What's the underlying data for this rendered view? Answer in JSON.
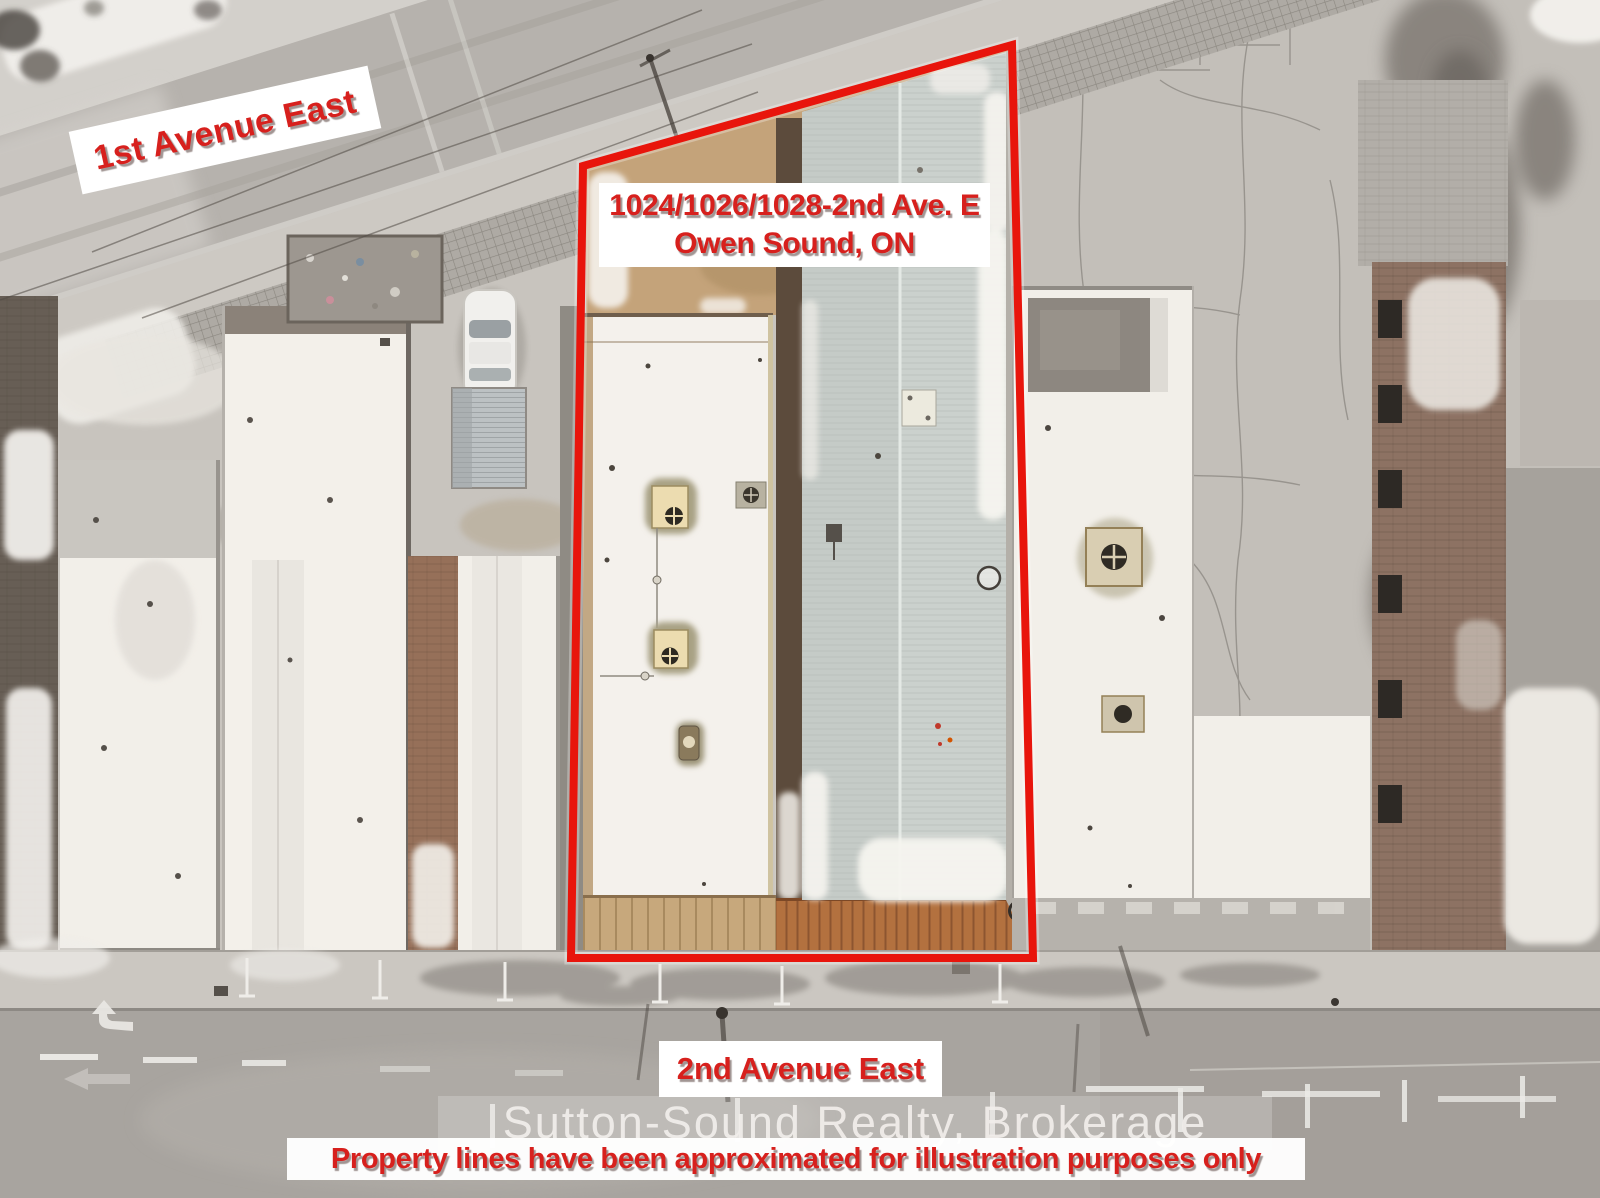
{
  "labels": {
    "street_top": "1st Avenue East",
    "address_line1": "1024/1026/1028-2nd Ave. E",
    "address_line2": "Owen Sound, ON",
    "street_bottom": "2nd Avenue East",
    "watermark": "Sutton-Sound Realty, Brokerage",
    "disclaimer": "Property lines have been approximated for illustration purposes only"
  },
  "colors": {
    "boundary_red": "#e8150c",
    "label_text_red": "#d7201d",
    "label_background": "#ffffff",
    "watermark_text": "#f1eee9",
    "snow": "#f3f0ea",
    "pavement": "#c3bfb9",
    "road": "#a8a49f",
    "metal_roof": "#cbd1cd",
    "dirt_tan": "#c4a37a"
  },
  "property_boundary": {
    "points": "583,166 1012,45 1033,958 571,958",
    "stroke_width": 8
  }
}
